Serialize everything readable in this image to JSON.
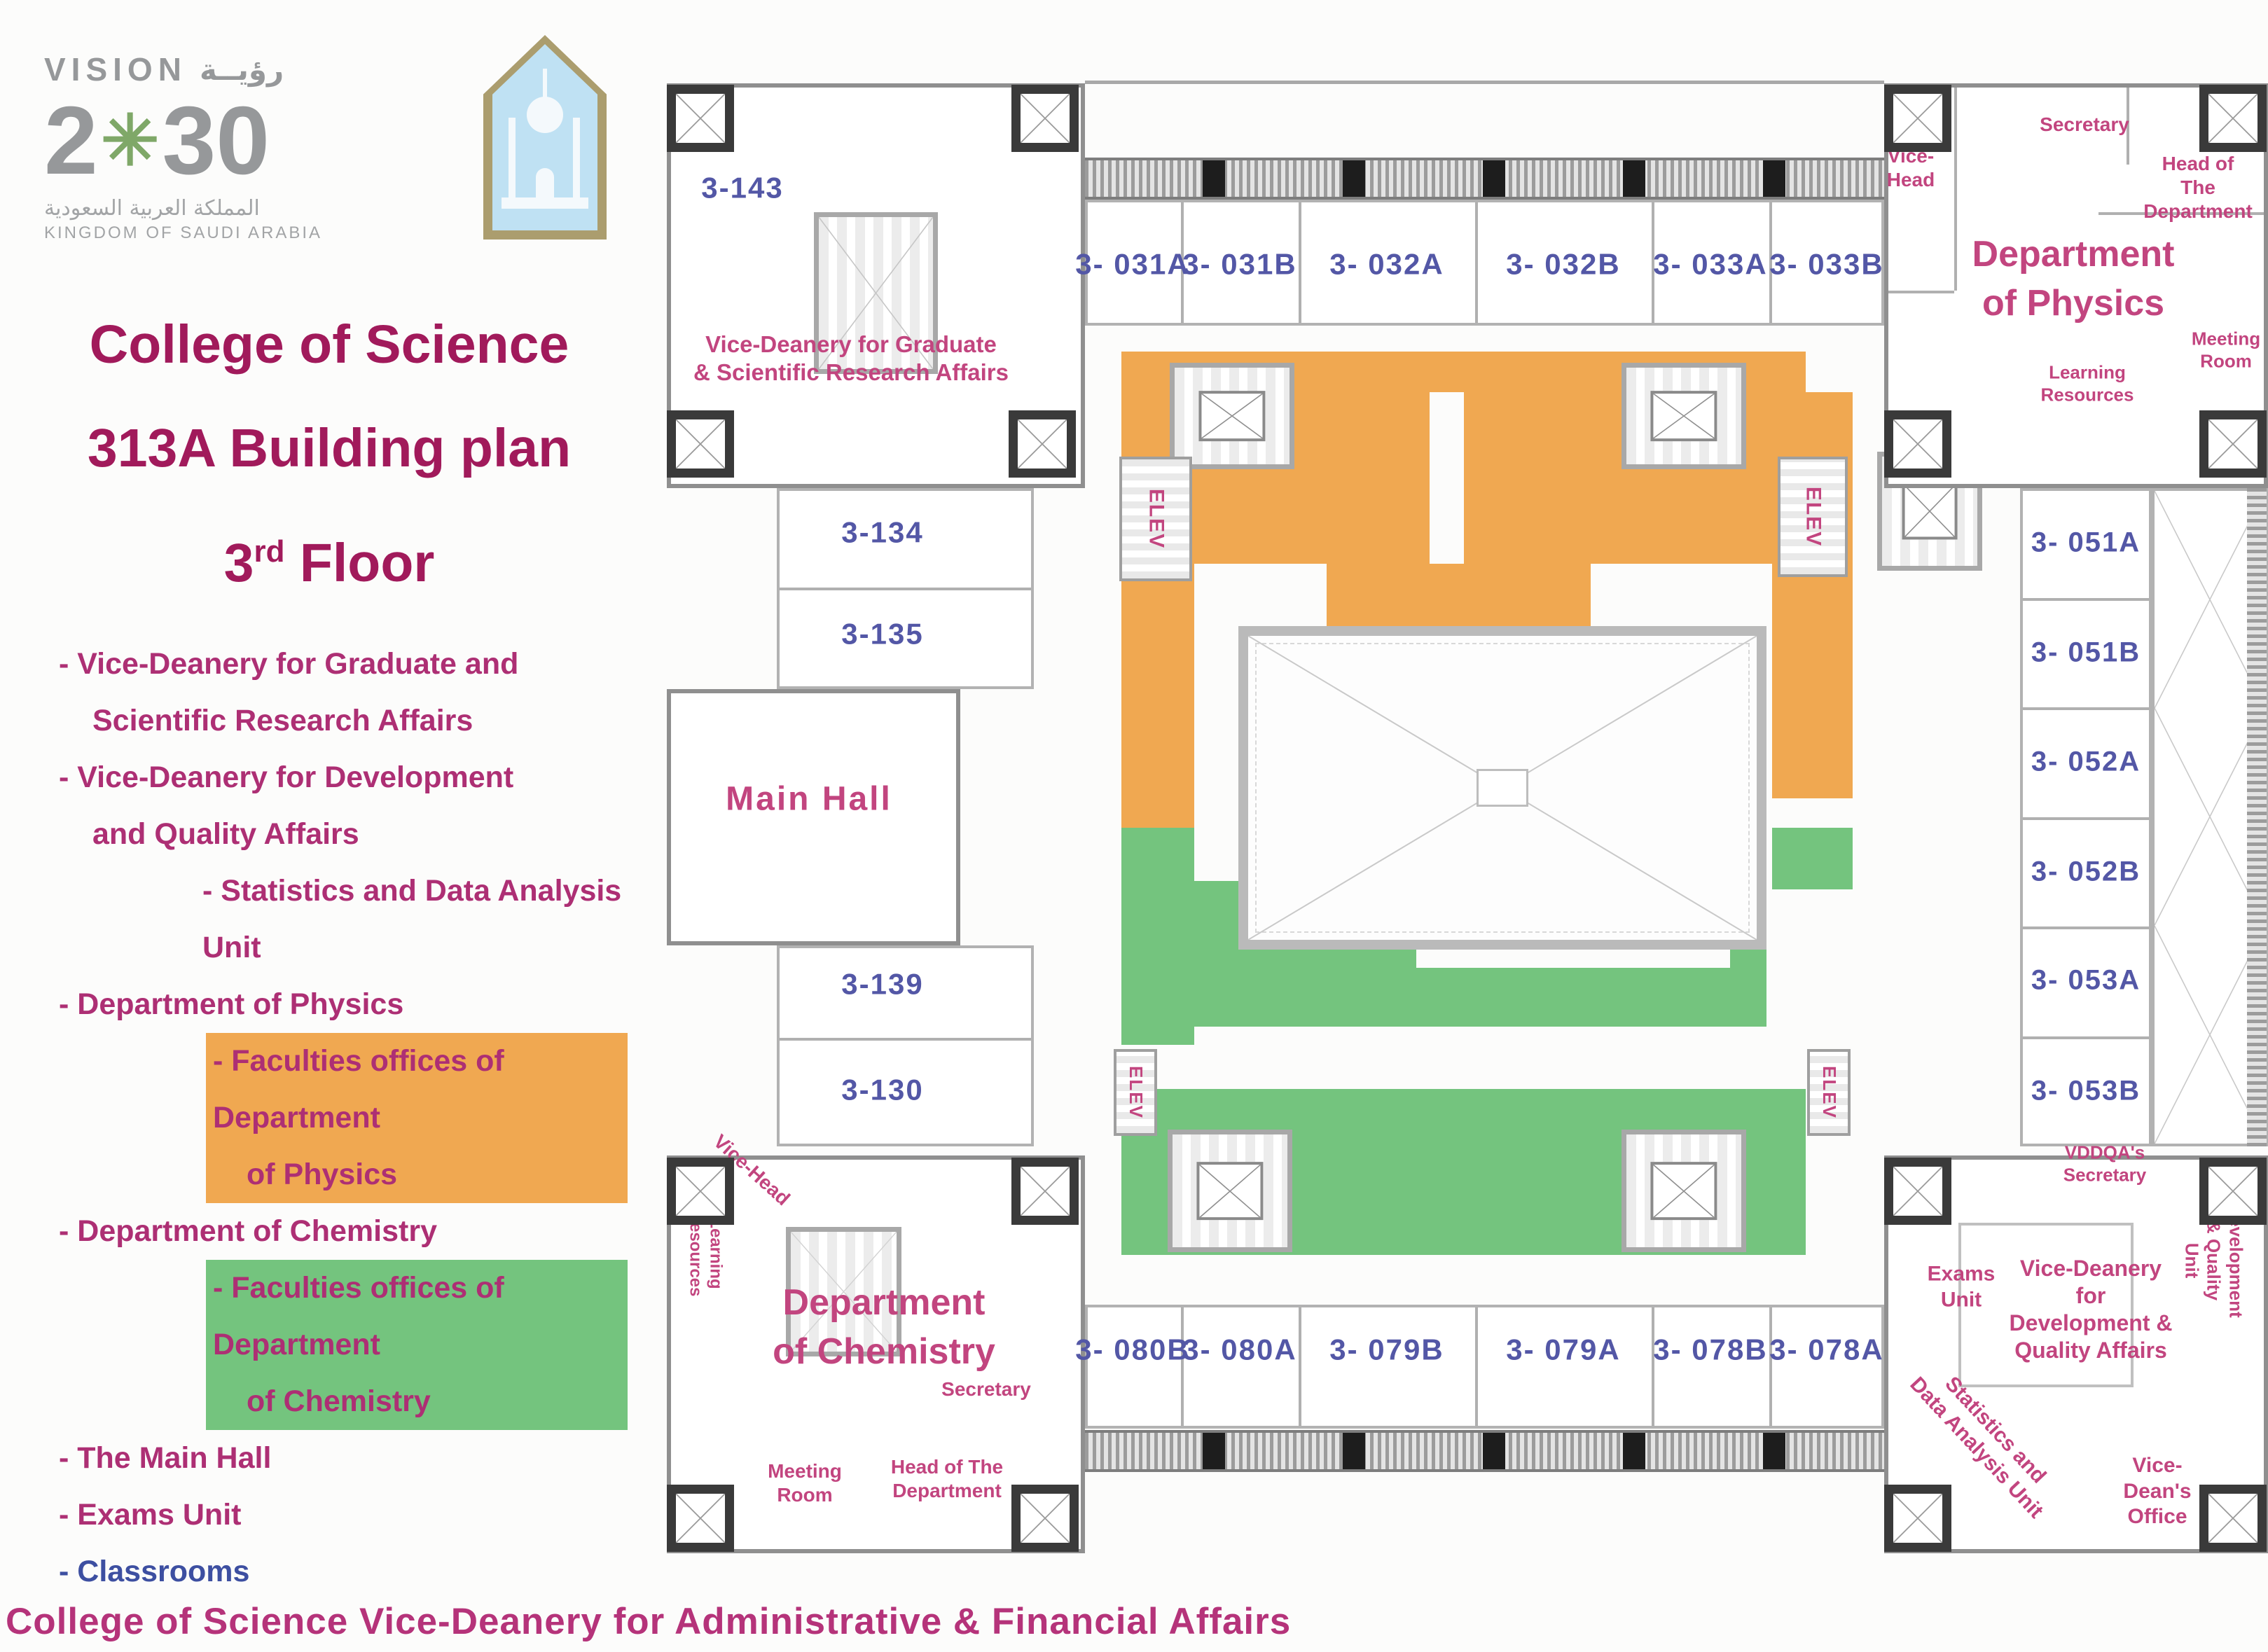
{
  "colors": {
    "orange": "#F0A851",
    "green": "#74C47E",
    "title_magenta": "#A11A5B",
    "legend_magenta": "#AD2F74",
    "room_number_blue": "#5357A6",
    "plan_label_pink": "#C2457F",
    "classrooms_blue": "#3D4FA1",
    "footer_pink": "#B5337A",
    "wall_gray": "#8F8F8F"
  },
  "icons": {
    "palm_emblem": "✳"
  },
  "branding": {
    "vision": {
      "word_en": "VISION",
      "word_ar": "رؤيــة",
      "year_left": "2",
      "year_right": "30",
      "country_ar": "المملكة العربية السعودية",
      "country_en": "KINGDOM OF SAUDI ARABIA"
    }
  },
  "title": {
    "line1": "College of Science",
    "line2": "313A Building plan",
    "floor_num": "3",
    "floor_sup": "rd",
    "floor_word": " Floor"
  },
  "legend": {
    "items": [
      {
        "l1": "- Vice-Deanery for Graduate and",
        "l2": "Scientific Research Affairs"
      },
      {
        "l1": "- Vice-Deanery for Development",
        "l2": "and Quality Affairs"
      },
      {
        "l1": "- Statistics and Data Analysis Unit"
      },
      {
        "l1": "- Department of Physics"
      },
      {
        "l1": "- Faculties offices of Department",
        "l2": "of Physics"
      },
      {
        "l1": "- Department of Chemistry"
      },
      {
        "l1": "- Faculties offices of Department",
        "l2": "of Chemistry"
      },
      {
        "l1": "- The Main Hall"
      },
      {
        "l1": "- Exams Unit"
      },
      {
        "l1": "- Classrooms"
      }
    ]
  },
  "plan": {
    "elev": "ELEV",
    "northwest": {
      "room_143": "3-143",
      "vice_deanery": "Vice-Deanery for Graduate\n& Scientific Research Affairs"
    },
    "west": {
      "room_134": "3-134",
      "room_135": "3-135",
      "main_hall": "Main Hall",
      "room_139": "3-139",
      "room_130": "3-130"
    },
    "top_rooms": [
      "3- 031A",
      "3- 031B",
      "3- 032A",
      "3- 032B",
      "3- 033A",
      "3- 033B"
    ],
    "physics": {
      "vice_head": "Vice-\nHead",
      "secretary": "Secretary",
      "head_of_department": "Head of The\nDepartment",
      "department": "Department\nof Physics",
      "meeting_room": "Meeting\nRoom",
      "learning_resources": "Learning\nResources"
    },
    "east_rooms": [
      "3- 051A",
      "3- 051B",
      "3- 052A",
      "3- 052B",
      "3- 053A",
      "3- 053B"
    ],
    "chemistry": {
      "vice_head": "Vice-Head",
      "learning_resources": "Learning\nResources",
      "department": "Department\nof Chemistry",
      "secretary": "Secretary",
      "meeting_room": "Meeting\nRoom",
      "head_of_department": "Head of The\nDepartment"
    },
    "bottom_rooms": [
      "3- 080B",
      "3- 080A",
      "3- 079B",
      "3- 079A",
      "3- 078B",
      "3- 078A"
    ],
    "southeast": {
      "vddqa_secretary": "VDDQA's\nSecretary",
      "exams_unit": "Exams\nUnit",
      "vice_deanery": "Vice-Deanery for\nDevelopment &\nQuality Affairs",
      "development_quality_unit": "Development\n& Quality Unit",
      "statistics_unit": "Statistics and\nData Analysis Unit",
      "vice_dean_office": "Vice-Dean's\nOffice"
    }
  },
  "footer": {
    "caption": "College of Science Vice-Deanery for Administrative & Financial Affairs"
  }
}
